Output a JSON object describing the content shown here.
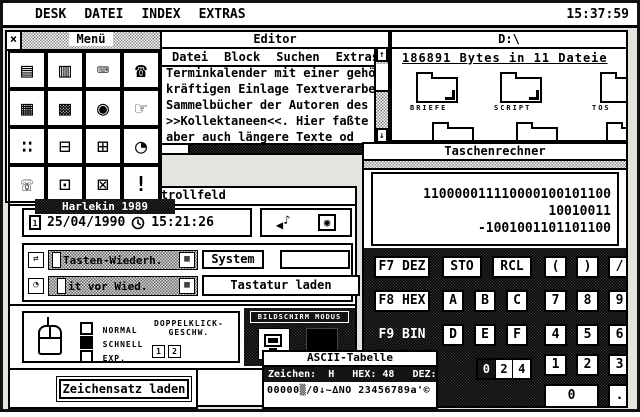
{
  "menubar": {
    "items": [
      "DESK",
      "DATEI",
      "INDEX",
      "EXTRAS"
    ],
    "clock": "15:37:59"
  },
  "menu_window": {
    "title": "Menü",
    "close_glyph": "×",
    "icons": [
      {
        "name": "notes-icon",
        "glyph": "▤"
      },
      {
        "name": "card-index-icon",
        "glyph": "▥"
      },
      {
        "name": "typewriter-icon",
        "glyph": "⌨"
      },
      {
        "name": "telephone-icon",
        "glyph": "☎"
      },
      {
        "name": "calendar-icon",
        "glyph": "▦"
      },
      {
        "name": "calculator-icon",
        "glyph": "▩"
      },
      {
        "name": "magnifier-icon",
        "glyph": "◉"
      },
      {
        "name": "pointer-hand-icon",
        "glyph": "☞"
      },
      {
        "name": "dice-icon",
        "glyph": "∷"
      },
      {
        "name": "car-icon",
        "glyph": "⊟"
      },
      {
        "name": "floppy-icon",
        "glyph": "⊞"
      },
      {
        "name": "alarm-clock-icon",
        "glyph": "◔"
      },
      {
        "name": "handset-icon",
        "glyph": "☏"
      },
      {
        "name": "printer-icon",
        "glyph": "⊡"
      },
      {
        "name": "terminal-icon",
        "glyph": "⊠"
      },
      {
        "name": "exclamation-icon",
        "glyph": "!"
      }
    ]
  },
  "editor": {
    "title": "Editor",
    "menu": [
      "Datei",
      "Block",
      "Suchen",
      "Extras"
    ],
    "lines": [
      "Terminkalender mit einer gehöri",
      "kräftigen Einlage Textverarbeit",
      "Sammelbücher der Autoren des 18",
      ">>Kollektaneen<<. Hier faßte ma",
      "aber auch längere Texte od"
    ],
    "scroll_up": "↑",
    "scroll_down": "↓"
  },
  "file_window": {
    "title": "D:\\",
    "info": "186891 Bytes in 11 Dateie",
    "folders": [
      "BRIEFE",
      "SCRIPT",
      "TOS"
    ]
  },
  "calculator": {
    "title": "Taschenrechner",
    "display": [
      "110000011110000100101100",
      "10010011",
      "-1001001101101100"
    ],
    "modes": [
      {
        "label": "F7 DEZ",
        "active": false
      },
      {
        "label": "F8 HEX",
        "active": false
      },
      {
        "label": "F9 BIN",
        "active": true
      }
    ],
    "sto": "STO",
    "rcl": "RCL",
    "hex": [
      "A",
      "B",
      "C",
      "D",
      "E",
      "F"
    ],
    "ops": [
      "(",
      ")",
      "/"
    ],
    "digits": [
      [
        "7",
        "8",
        "9"
      ],
      [
        "4",
        "5",
        "6"
      ],
      [
        "1",
        "2",
        "3"
      ]
    ],
    "zero": "0",
    "dot": ".",
    "bits": [
      "0",
      "2",
      "4"
    ]
  },
  "harlekin_label": "Harlekin 1989",
  "kontrollfeld": {
    "title": "Kontrollfeld",
    "date": "25/04/1990",
    "time": "15:21:26",
    "cal_digit": "1",
    "speaker": "◀",
    "note": "♪",
    "bell": "◉",
    "keyboard": {
      "icon1": "⇄",
      "slider1": "Tasten-Wiederh.",
      "end1": "▦",
      "icon2": "◔",
      "slider2": "it vor Wied.",
      "end2": "▦",
      "system": "System",
      "eigene": "eigene",
      "load": "Tastatur laden"
    },
    "mouse": {
      "options": [
        {
          "label": "NORMAL",
          "checked": false
        },
        {
          "label": "SCHNELL",
          "checked": true
        },
        {
          "label": "EXP.",
          "checked": false
        }
      ],
      "dclick1": "DOPPELKLICK-",
      "dclick2": "GESCHW.",
      "speed": [
        "1",
        "2"
      ]
    },
    "screen_mode": "BILDSCHIRM MODUS",
    "charset_button": "Zeichensatz laden"
  },
  "ascii_window": {
    "title": "ASCII-Tabelle",
    "info": "Zeichen:  H   HEX: 48   DEZ: 72",
    "preview": "00000▒/0↓~∆NO 23456789a'©"
  }
}
